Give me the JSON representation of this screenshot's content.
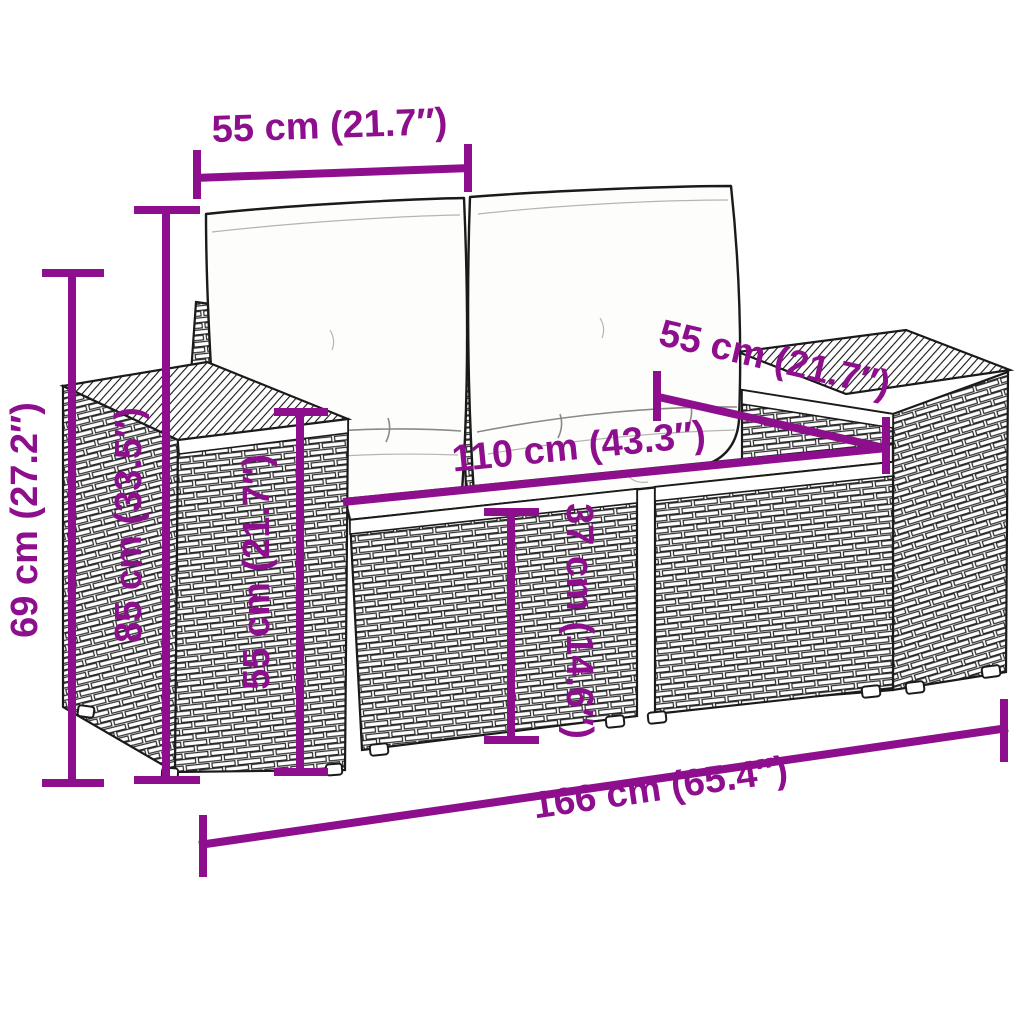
{
  "figure_type": "product-dimension-diagram",
  "subject": "rattan two-seater garden sofa with back and seat cushions",
  "colors": {
    "accent": "#8E0F8E",
    "outline": "#1a1a1a",
    "background": "#ffffff",
    "cushion": "#fdfdfb"
  },
  "dimensions": {
    "cushion_width": {
      "label": "55 cm (21.7″)"
    },
    "seat_depth": {
      "label": "55 cm (21.7″)"
    },
    "seat_width": {
      "label": "110 cm (43.3″)"
    },
    "overall_depth": {
      "label": "69 cm (27.2″)"
    },
    "total_height": {
      "label": "85 cm (33.5″)"
    },
    "armrest_height": {
      "label": "55 cm (21.7″)"
    },
    "seat_height": {
      "label": "37 cm (14.6″)"
    },
    "total_width": {
      "label": "166 cm (65.4″)"
    }
  }
}
